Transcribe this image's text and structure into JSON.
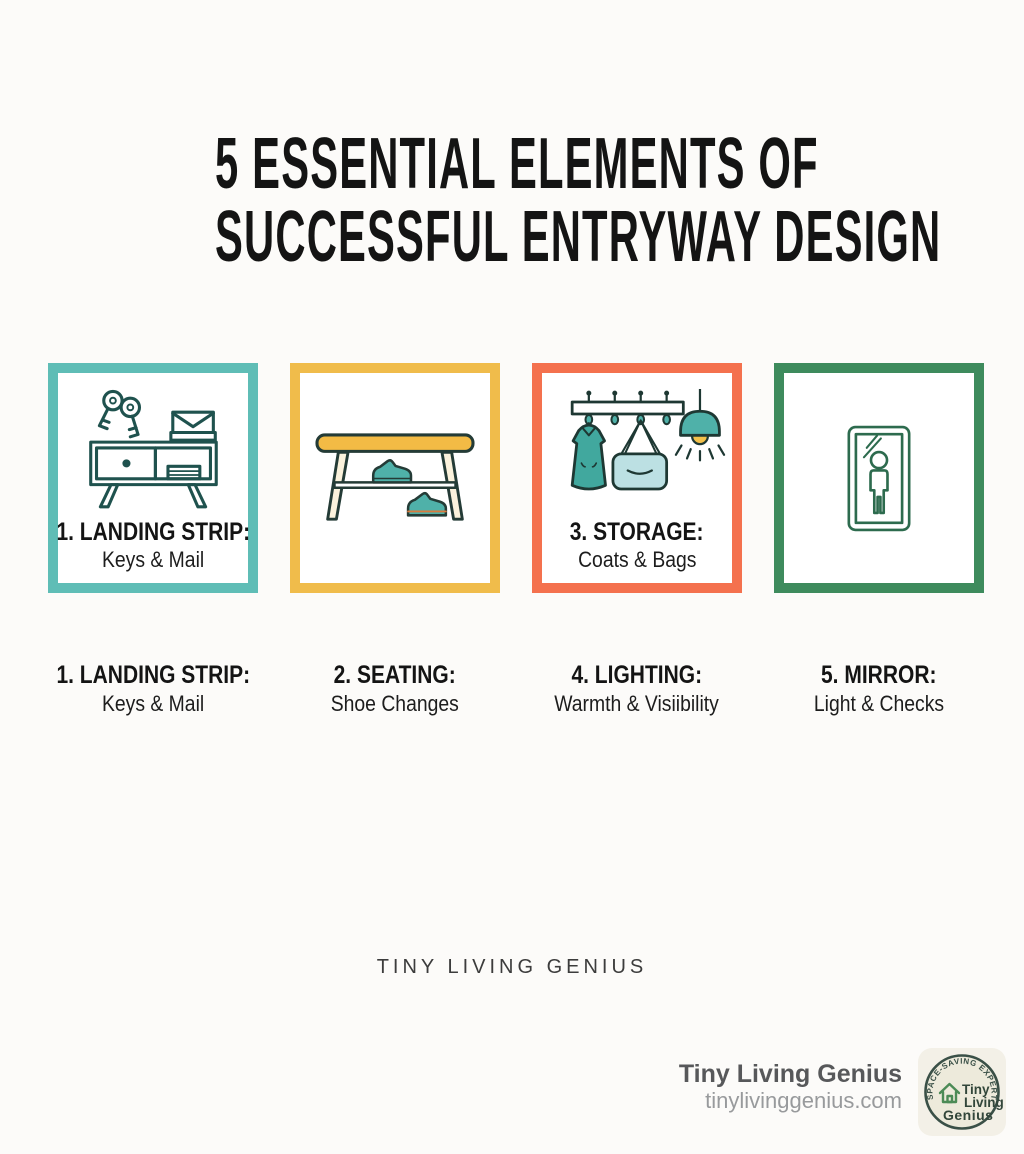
{
  "title": {
    "line1": "5 ESSENTIAL ELEMENTS OF",
    "line2": "SUCCESSFUL ENTRYWAY DESIGN"
  },
  "cards": [
    {
      "name": "landing-strip",
      "border_color": "#5FBDB6",
      "icon": "console-table-with-keys-and-mail-icon",
      "label": "1. LANDING STRIP:",
      "sublabel": "Keys & Mail"
    },
    {
      "name": "seating",
      "border_color": "#F0BC4B",
      "icon": "bench-with-shoes-icon"
    },
    {
      "name": "storage",
      "border_color": "#F4714E",
      "icon": "coat-rack-bag-and-pendant-lamp-icon",
      "label": "3. STORAGE:",
      "sublabel": "Coats & Bags"
    },
    {
      "name": "mirror",
      "border_color": "#3E8B5D",
      "icon": "full-length-mirror-with-person-icon"
    }
  ],
  "captions": [
    {
      "label": "1. LANDING STRIP:",
      "sublabel": "Keys & Mail"
    },
    {
      "label": "2. SEATING:",
      "sublabel": "Shoe Changes"
    },
    {
      "label": "4. LIGHTING:",
      "sublabel": "Warmth & Visiibility"
    },
    {
      "label": "5. MIRROR:",
      "sublabel": "Light & Checks"
    }
  ],
  "watermark": "TINY LIVING GENIUS",
  "footer": {
    "brand": "Tiny Living Genius",
    "website": "tinylivinggenius.com",
    "badge": {
      "arc_text": "SPACE-SAVING EXPERT",
      "line1": "Tiny",
      "line2": "Living",
      "line3": "Genius",
      "icon": "house-icon"
    }
  },
  "colors": {
    "background": "#FCFBF9",
    "title_text": "#141414",
    "card_teal": "#5FBDB6",
    "card_amber": "#F0BC4B",
    "card_coral": "#F4714E",
    "card_green": "#3E8B5D",
    "icon_outline_dark_teal": "#1F524E",
    "icon_teal_fill": "#4FB1A9",
    "icon_yellow_fill": "#F3BB45",
    "icon_bag_fill": "#BCE0E3",
    "icon_mirror_green": "#2D6B4E",
    "watermark_text": "#3C3C3C",
    "footer_brand_text": "#57585A",
    "footer_website_text": "#989A9C",
    "badge_background": "#F3F0E7",
    "badge_circle_fill": "#EDEADB",
    "badge_ring": "#3A5047",
    "badge_house_green": "#4C8B56"
  }
}
